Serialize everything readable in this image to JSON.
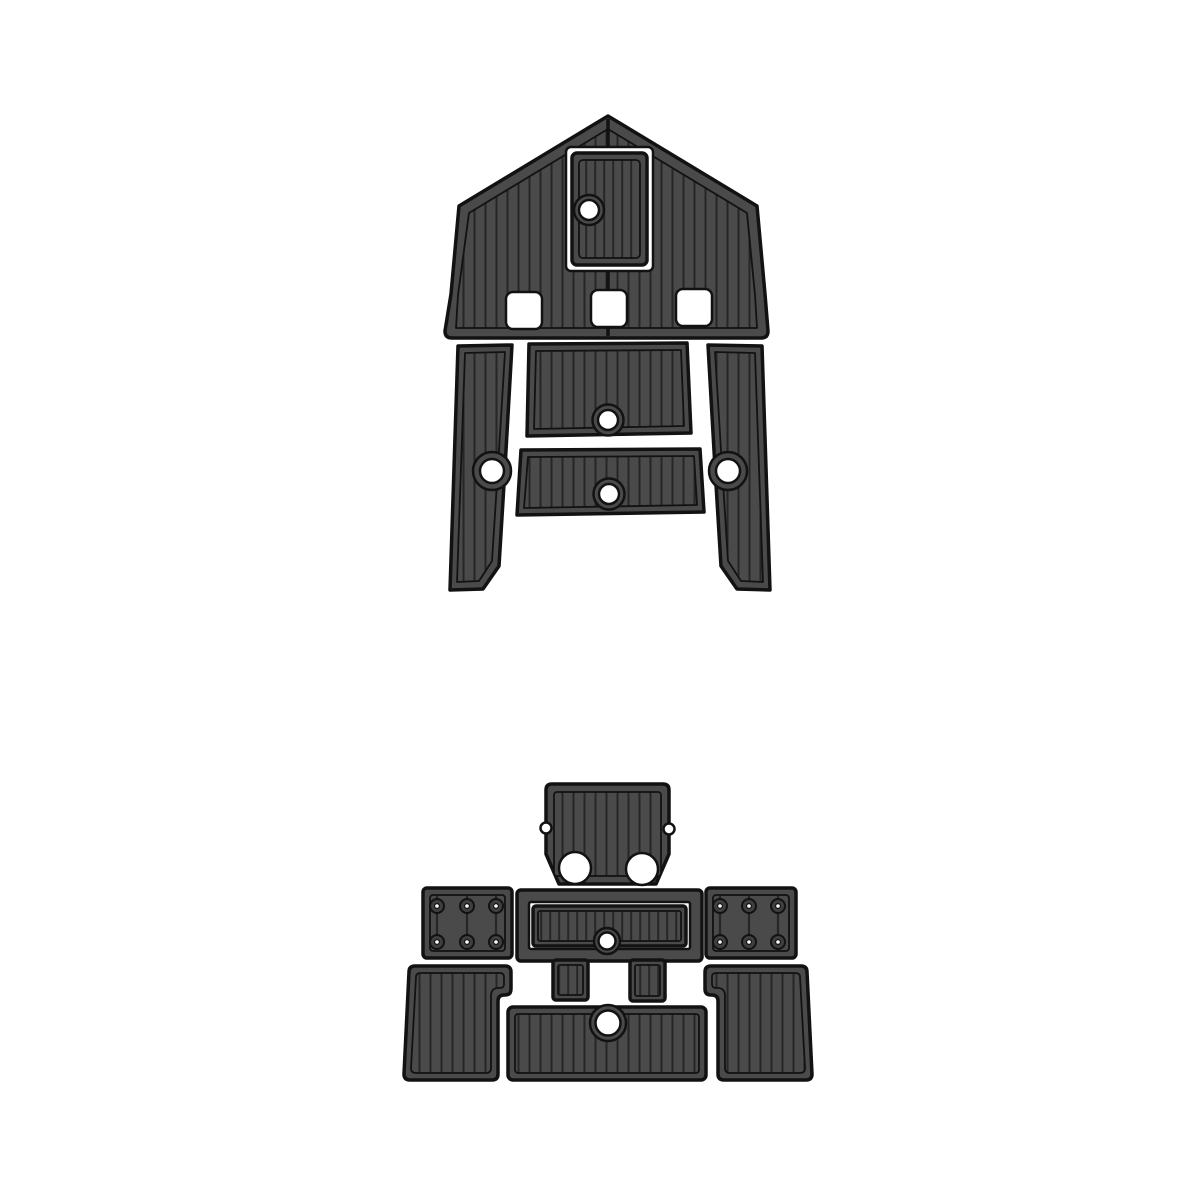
{
  "page": {
    "background": "#ffffff",
    "visible_text": ""
  },
  "colors": {
    "pad_fill": "#4a4a4a",
    "plank_line": "#262626",
    "outline": "#121212",
    "hole_fill": "#ffffff",
    "bolt_fill": "#3f3f3f",
    "page_bg": "#ffffff"
  },
  "product": {
    "kind": "EVA foam boat decking pad set, faux-teak vertical plank texture, top view cut diagram",
    "assemblies": [
      {
        "id": "upper",
        "label": "bow / foredeck pad group",
        "piece_count": 6,
        "pieces": [
          "pentagonal bow pad with center seam, hatch cutout and 3 square cutouts",
          "hatch insert pad with round finger hole",
          "port side runner pad with round keyhole",
          "starboard side runner pad with round keyhole",
          "upper mid-deck pad with bottom keyhole",
          "lower mid-deck pad with bottom keyhole"
        ]
      },
      {
        "id": "lower",
        "label": "cockpit / transom pad group",
        "piece_count": 9,
        "pieces": [
          "transom pad with two round engine cutouts and two side notches",
          "port hinge pad with 6 bolt holes",
          "starboard hinge pad with 6 bolt holes",
          "framed hatch pad with inner insert and keyhole",
          "left step pad",
          "right step pad",
          "port floor pad with corner notch",
          "starboard floor pad with corner notch",
          "aft floor pad with top keyhole"
        ]
      }
    ]
  }
}
